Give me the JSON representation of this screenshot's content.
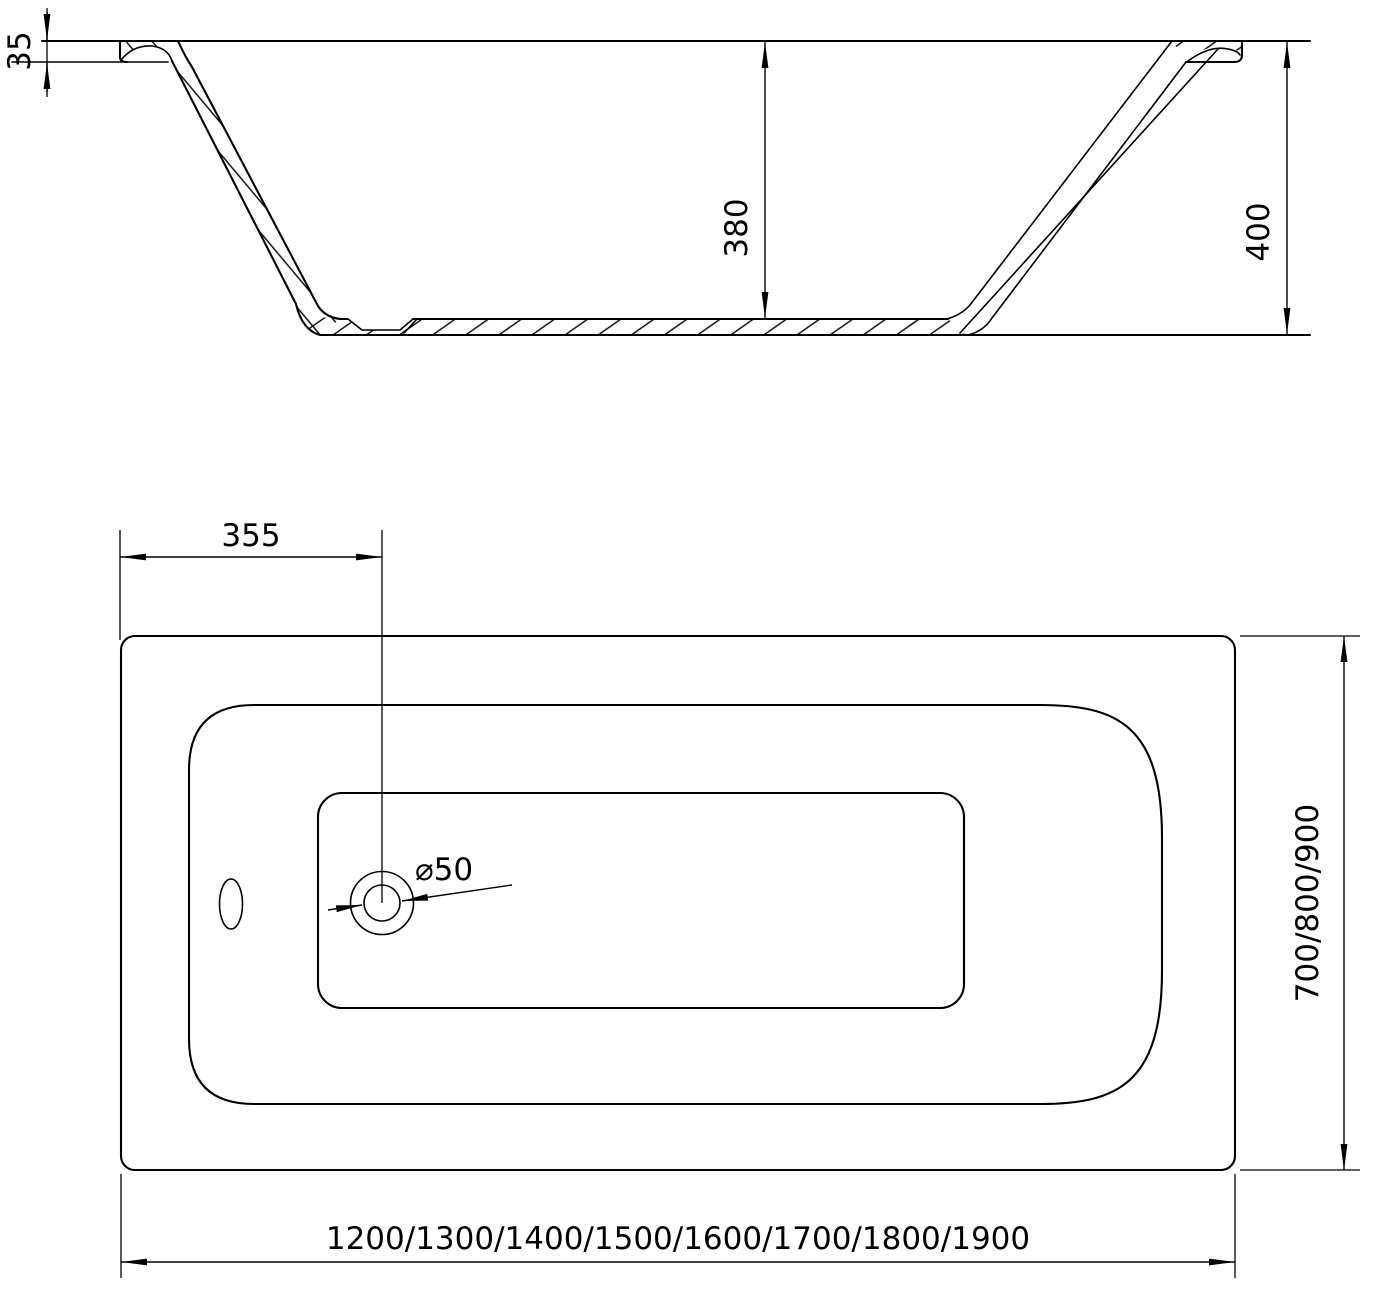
{
  "drawing": {
    "background": "#ffffff",
    "line_color": "#000000",
    "section_view": {
      "rim_height_label": "35",
      "inner_depth_label": "380",
      "overall_height_label": "400"
    },
    "plan_view": {
      "drain_offset_label": "355",
      "drain_diameter_label": "⌀50",
      "width_options_label": "700/800/900",
      "length_options_label": "1200/1300/1400/1500/1600/1700/1800/1900"
    }
  }
}
